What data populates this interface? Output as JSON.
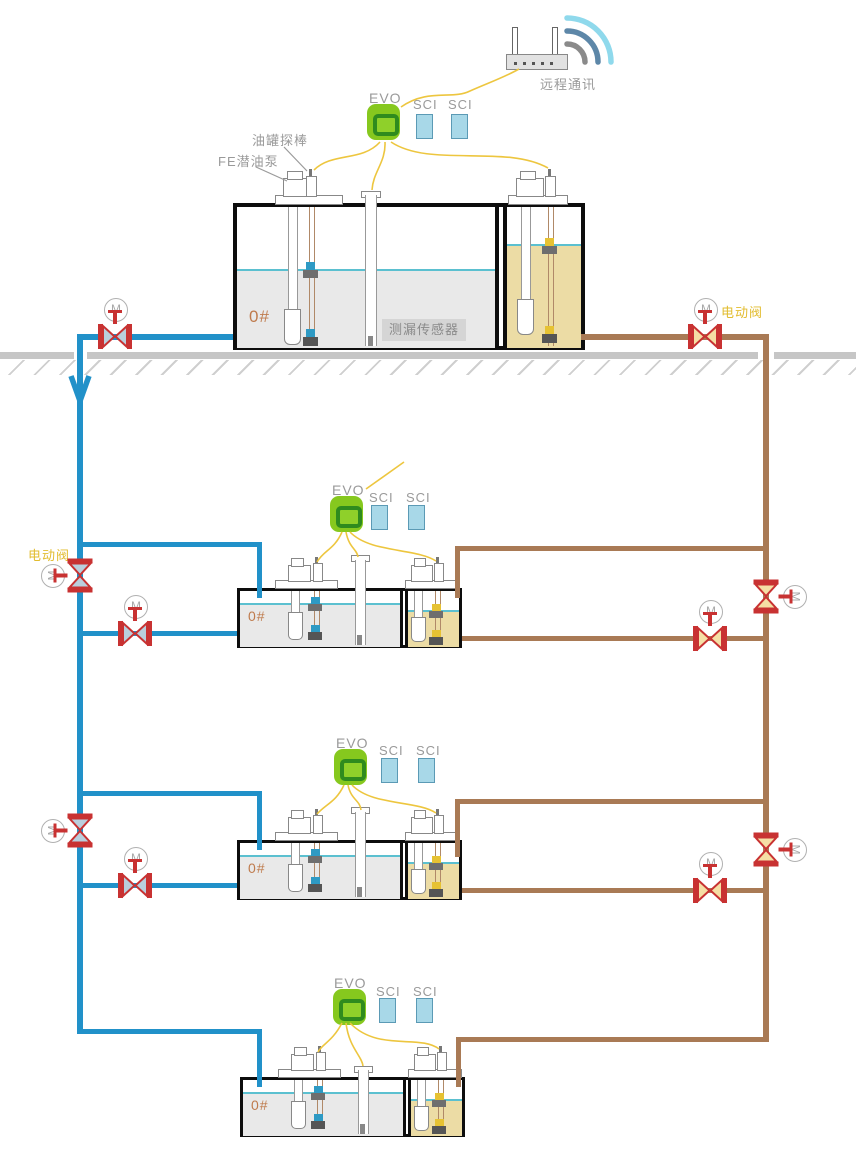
{
  "labels": {
    "evo": "EVO",
    "sci": "SCI",
    "motor": "M",
    "remote_comm": "远程通讯",
    "tank_probe": "油罐探棒",
    "fe_pump": "FE潜油泵",
    "leak_sensor": "测漏传感器",
    "electric_valve": "电动阀",
    "oil_grade": "0#"
  },
  "colors": {
    "supply_pipe_blue": "#2191c9",
    "return_pipe_brown": "#a97a55",
    "signal_wire_yellow": "#edc63f",
    "valve_red": "#c83232",
    "valve_tri_blue": "#b9cfdd",
    "valve_tri_tan": "#f5dfa5",
    "evo_green": "#86c81e",
    "evo_ring_green": "#2f8b1e",
    "sci_blue": "#a8d8e8",
    "tank_fill_grey": "#e9e9e9",
    "tank_fill_oil": "#ecdca5",
    "liquid_line_cyan": "#5bc0d0",
    "ground_grey": "#c6c6c6",
    "label_grey": "#9a9a9a",
    "grade_label_orange": "#bf7b4d",
    "valve_label_yellow": "#e2bc2f",
    "wifi_arc_inner": "#8a8a8a",
    "wifi_arc_mid": "#5d87a8",
    "wifi_arc_outer": "#8fd9ec"
  },
  "icons": {
    "wifi_router": "router body with two antennas",
    "wifi_signal": "three concentric arcs",
    "motorized_valve": "red bowtie valve with M motor circle",
    "flow_arrow": "downward chevron on blue pipe",
    "leak_sensor_tube": "vertical white tube through tank",
    "submersible_pump": "tube with rounded cylinder in liquid",
    "tank_probe_wire": "double wire with float and anchor"
  },
  "tiers": [
    {
      "id": "surface-tank",
      "grade": "0#",
      "devices": [
        "EVO",
        "SCI",
        "SCI"
      ],
      "annotations": [
        "远程通讯",
        "油罐探棒",
        "FE潜油泵",
        "测漏传感器",
        "电动阀",
        "M"
      ]
    },
    {
      "id": "underground-tank-1",
      "grade": "0#",
      "devices": [
        "EVO",
        "SCI",
        "SCI"
      ],
      "annotations": [
        "电动阀",
        "M"
      ]
    },
    {
      "id": "underground-tank-2",
      "grade": "0#",
      "devices": [
        "EVO",
        "SCI",
        "SCI"
      ],
      "annotations": [
        "M"
      ]
    },
    {
      "id": "underground-tank-3",
      "grade": "0#",
      "devices": [
        "EVO",
        "SCI",
        "SCI"
      ],
      "annotations": []
    }
  ]
}
